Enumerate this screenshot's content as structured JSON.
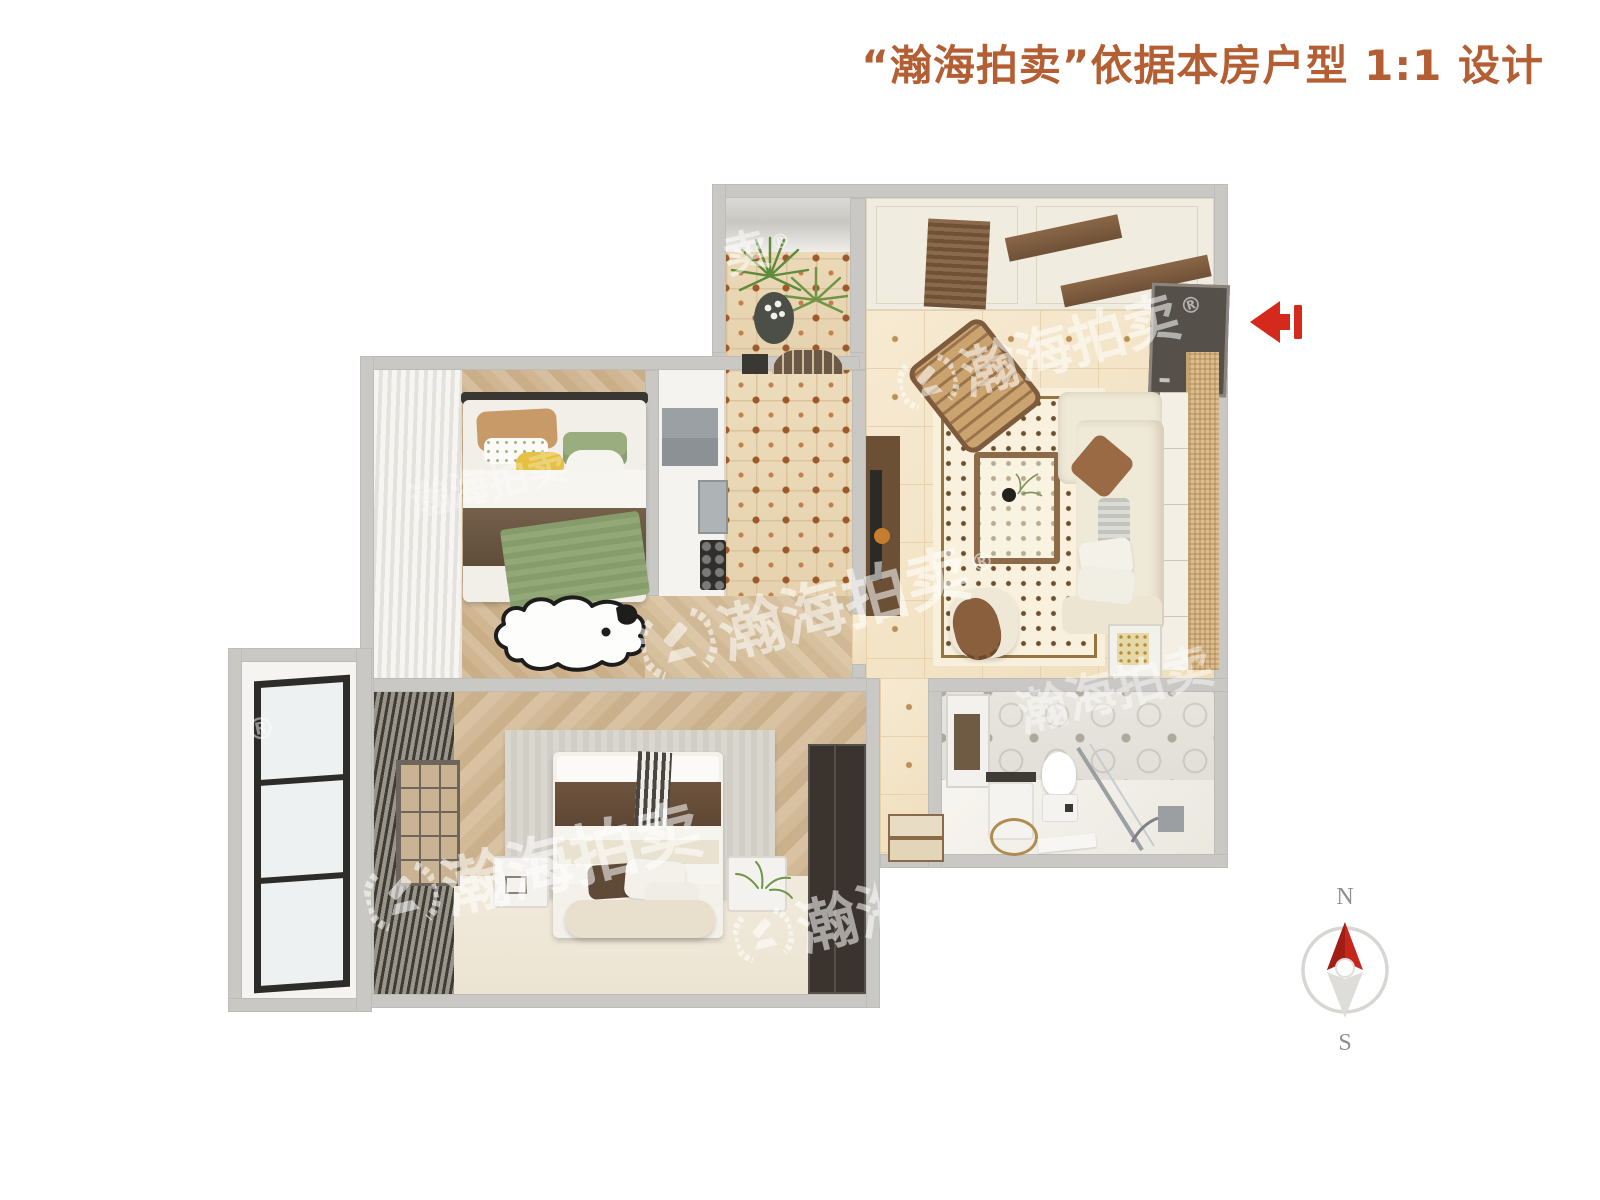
{
  "header": {
    "title": "“瀚海拍卖”依据本房户型 1:1 设计",
    "title_color": "#b35f33"
  },
  "watermark": {
    "brand": "瀚海拍卖",
    "brand_partial": "卖",
    "registered": "®"
  },
  "compass": {
    "north": "N",
    "south": "S",
    "needle_color": "#c5271c"
  },
  "entry_arrow": {
    "direction": "left",
    "color": "#d5291b"
  },
  "palette": {
    "wall_gray": "#c9c8c4",
    "tile_beige": "#f3e5c8",
    "wood": "#cfb591",
    "sofa_cream": "#efe9d7",
    "accent_brown": "#7b5a3e"
  }
}
